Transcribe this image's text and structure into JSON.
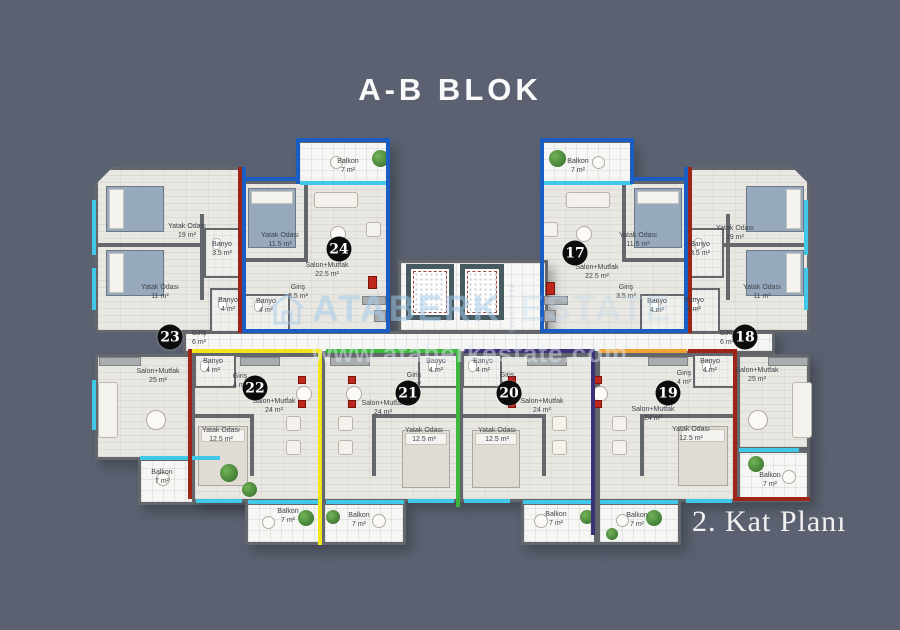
{
  "title": "A-B BLOK",
  "floor_label": "2. Kat Planı",
  "watermark": {
    "brand": "ATABERK",
    "brand_secondary": "ESTATE",
    "tagline": "REAL ESTATE",
    "url": "www.ataberkestate.com"
  },
  "colors": {
    "background": "#5b6170",
    "floor": "#e9e7e2",
    "tile": "#f6f6f4",
    "wall": "#64676b",
    "window_glass": "#41c7e8",
    "badge": "#0c0c0c",
    "outline_red": "#9c2518",
    "outline_blue": "#1a5ec4",
    "outline_yellow": "#f2e41c",
    "outline_green": "#3cb93c",
    "outline_navy": "#3a3176",
    "outline_orange": "#f2a336"
  },
  "apartments": [
    {
      "number": "23",
      "outline_color": "#9c2518",
      "badge": {
        "x": 170,
        "y": 337
      },
      "outline": [
        [
          238,
          167,
          4,
          166
        ],
        [
          188,
          349,
          56,
          4
        ],
        [
          188,
          349,
          4,
          150
        ]
      ],
      "rooms": [
        {
          "name": "Yatak Odası",
          "area": "19 m²",
          "x": 187,
          "y": 231
        },
        {
          "name": "Banyo",
          "area": "3.5 m²",
          "x": 222,
          "y": 249
        },
        {
          "name": "Yatak Odası",
          "area": "11 m²",
          "x": 160,
          "y": 292
        },
        {
          "name": "Banyo",
          "area": "4 m²",
          "x": 228,
          "y": 305
        },
        {
          "name": "Giriş",
          "area": "6 m²",
          "x": 199,
          "y": 338
        },
        {
          "name": "Salon+Mutfak",
          "area": "25 m²",
          "x": 158,
          "y": 376
        },
        {
          "name": "Balkon",
          "area": "7 m²",
          "x": 162,
          "y": 477
        }
      ]
    },
    {
      "number": "24",
      "outline_color": "#1a5ec4",
      "badge": {
        "x": 339,
        "y": 249
      },
      "outline": [
        [
          242,
          167,
          4,
          166
        ],
        [
          242,
          177,
          58,
          4
        ],
        [
          296,
          138,
          4,
          46
        ],
        [
          296,
          138,
          94,
          4
        ],
        [
          386,
          138,
          4,
          195
        ],
        [
          242,
          329,
          148,
          4
        ]
      ],
      "rooms": [
        {
          "name": "Balkon",
          "area": "7 m²",
          "x": 348,
          "y": 166
        },
        {
          "name": "Yatak Odası",
          "area": "11.5 m²",
          "x": 280,
          "y": 240
        },
        {
          "name": "Salon+Mutfak",
          "area": "22.5 m²",
          "x": 327,
          "y": 270
        },
        {
          "name": "Giriş",
          "area": "3.5 m²",
          "x": 298,
          "y": 292
        },
        {
          "name": "Banyo",
          "area": "4 m²",
          "x": 266,
          "y": 306
        }
      ]
    },
    {
      "number": "17",
      "outline_color": "#1a5ec4",
      "badge": {
        "x": 575,
        "y": 253
      },
      "outline": [
        [
          684,
          167,
          4,
          166
        ],
        [
          630,
          177,
          58,
          4
        ],
        [
          630,
          138,
          4,
          46
        ],
        [
          540,
          138,
          94,
          4
        ],
        [
          540,
          138,
          4,
          195
        ],
        [
          540,
          329,
          148,
          4
        ]
      ],
      "rooms": [
        {
          "name": "Balkon",
          "area": "7 m²",
          "x": 578,
          "y": 166
        },
        {
          "name": "Yatak Odası",
          "area": "11.5 m²",
          "x": 638,
          "y": 240
        },
        {
          "name": "Salon+Mutfak",
          "area": "22.5 m²",
          "x": 597,
          "y": 272
        },
        {
          "name": "Giriş",
          "area": "3.5 m²",
          "x": 626,
          "y": 292
        },
        {
          "name": "Banyo",
          "area": "4 m²",
          "x": 657,
          "y": 306
        }
      ]
    },
    {
      "number": "18",
      "outline_color": "#9c2518",
      "badge": {
        "x": 745,
        "y": 337
      },
      "outline": [
        [
          688,
          167,
          4,
          166
        ],
        [
          688,
          349,
          49,
          4
        ],
        [
          733,
          349,
          4,
          152
        ],
        [
          733,
          497,
          77,
          4
        ]
      ],
      "rooms": [
        {
          "name": "Yatak Odası",
          "area": "19 m²",
          "x": 735,
          "y": 233
        },
        {
          "name": "Banyo",
          "area": "3.5 m²",
          "x": 700,
          "y": 249
        },
        {
          "name": "Yatak Odası",
          "area": "11 m²",
          "x": 762,
          "y": 292
        },
        {
          "name": "Banyo",
          "area": "4 m²",
          "x": 694,
          "y": 305
        },
        {
          "name": "Giriş",
          "area": "6 m²",
          "x": 727,
          "y": 338
        },
        {
          "name": "Salon+Mutfak",
          "area": "25 m²",
          "x": 757,
          "y": 375
        },
        {
          "name": "Balkon",
          "area": "7 m²",
          "x": 770,
          "y": 480
        }
      ]
    },
    {
      "number": "22",
      "outline_color": "#f2e41c",
      "badge": {
        "x": 255,
        "y": 388
      },
      "outline": [
        [
          192,
          349,
          130,
          4
        ],
        [
          318,
          349,
          4,
          196
        ]
      ],
      "rooms": [
        {
          "name": "Banyo",
          "area": "4 m²",
          "x": 213,
          "y": 366
        },
        {
          "name": "Giriş",
          "area": "4 m²",
          "x": 240,
          "y": 381
        },
        {
          "name": "Salon+Mutfak",
          "area": "24 m²",
          "x": 274,
          "y": 406
        },
        {
          "name": "Yatak Odası",
          "area": "12.5 m²",
          "x": 221,
          "y": 435
        },
        {
          "name": "Balkon",
          "area": "7 m²",
          "x": 288,
          "y": 516
        }
      ]
    },
    {
      "number": "21",
      "outline_color": "#3cb93c",
      "badge": {
        "x": 408,
        "y": 393
      },
      "outline": [
        [
          326,
          349,
          134,
          4
        ],
        [
          456,
          349,
          4,
          158
        ]
      ],
      "rooms": [
        {
          "name": "Banyo",
          "area": "4 m²",
          "x": 436,
          "y": 366
        },
        {
          "name": "Giriş",
          "area": "4 m²",
          "x": 414,
          "y": 380
        },
        {
          "name": "Salon+Mutfak",
          "area": "24 m²",
          "x": 383,
          "y": 408
        },
        {
          "name": "Yatak Odası",
          "area": "12.5 m²",
          "x": 424,
          "y": 435
        },
        {
          "name": "Balkon",
          "area": "7 m²",
          "x": 359,
          "y": 520
        }
      ]
    },
    {
      "number": "20",
      "outline_color": "#3a3176",
      "badge": {
        "x": 509,
        "y": 393
      },
      "outline": [
        [
          464,
          349,
          131,
          4
        ],
        [
          591,
          349,
          4,
          186
        ]
      ],
      "rooms": [
        {
          "name": "Banyo",
          "area": "4 m²",
          "x": 483,
          "y": 366
        },
        {
          "name": "Giriş",
          "area": "4 m²",
          "x": 507,
          "y": 380
        },
        {
          "name": "Salon+Mutfak",
          "area": "24 m²",
          "x": 542,
          "y": 406
        },
        {
          "name": "Yatak Odası",
          "area": "12.5 m²",
          "x": 497,
          "y": 435
        },
        {
          "name": "Balkon",
          "area": "7 m²",
          "x": 556,
          "y": 519
        }
      ]
    },
    {
      "number": "19",
      "outline_color": "#f2a336",
      "badge": {
        "x": 668,
        "y": 393
      },
      "outline": [
        [
          599,
          349,
          88,
          4
        ]
      ],
      "rooms": [
        {
          "name": "Banyo",
          "area": "4 m²",
          "x": 710,
          "y": 366
        },
        {
          "name": "Giriş",
          "area": "4 m²",
          "x": 684,
          "y": 378
        },
        {
          "name": "Salon+Mutfak",
          "area": "24 m²",
          "x": 653,
          "y": 414
        },
        {
          "name": "Yatak Odası",
          "area": "12.5 m²",
          "x": 691,
          "y": 434
        },
        {
          "name": "Balkon",
          "area": "7 m²",
          "x": 637,
          "y": 520
        }
      ]
    },
    {
      "_": null
    }
  ],
  "furniture": [
    {
      "type": "bed-blue",
      "x": 106,
      "y": 186,
      "w": 58,
      "h": 46,
      "dir": "left"
    },
    {
      "type": "bed-blue",
      "x": 106,
      "y": 250,
      "w": 58,
      "h": 46,
      "dir": "left"
    },
    {
      "type": "bed-blue",
      "x": 746,
      "y": 186,
      "w": 58,
      "h": 46,
      "dir": "right"
    },
    {
      "type": "bed-blue",
      "x": 746,
      "y": 250,
      "w": 58,
      "h": 46,
      "dir": "right"
    },
    {
      "type": "bed-blue",
      "x": 248,
      "y": 188,
      "w": 48,
      "h": 60,
      "dir": "top"
    },
    {
      "type": "bed-blue",
      "x": 634,
      "y": 188,
      "w": 48,
      "h": 60,
      "dir": "top"
    },
    {
      "type": "bed-light",
      "x": 198,
      "y": 426,
      "w": 50,
      "h": 60,
      "dir": "top"
    },
    {
      "type": "bed-light",
      "x": 402,
      "y": 430,
      "w": 48,
      "h": 58,
      "dir": "top"
    },
    {
      "type": "bed-light",
      "x": 472,
      "y": 430,
      "w": 48,
      "h": 58,
      "dir": "top"
    },
    {
      "type": "bed-light",
      "x": 678,
      "y": 426,
      "w": 50,
      "h": 60,
      "dir": "top"
    },
    {
      "type": "sofa",
      "x": 98,
      "y": 382,
      "w": 20,
      "h": 56
    },
    {
      "type": "sofa",
      "x": 792,
      "y": 382,
      "w": 20,
      "h": 56
    },
    {
      "type": "sofa",
      "x": 314,
      "y": 192,
      "w": 44,
      "h": 16
    },
    {
      "type": "sofa",
      "x": 566,
      "y": 192,
      "w": 44,
      "h": 16
    },
    {
      "type": "armchair",
      "x": 366,
      "y": 222,
      "w": 15,
      "h": 15
    },
    {
      "type": "armchair",
      "x": 543,
      "y": 222,
      "w": 15,
      "h": 15
    },
    {
      "type": "armchair",
      "x": 286,
      "y": 416,
      "w": 15,
      "h": 15
    },
    {
      "type": "armchair",
      "x": 286,
      "y": 440,
      "w": 15,
      "h": 15
    },
    {
      "type": "armchair",
      "x": 338,
      "y": 416,
      "w": 15,
      "h": 15
    },
    {
      "type": "armchair",
      "x": 338,
      "y": 440,
      "w": 15,
      "h": 15
    },
    {
      "type": "armchair",
      "x": 552,
      "y": 416,
      "w": 15,
      "h": 15
    },
    {
      "type": "armchair",
      "x": 552,
      "y": 440,
      "w": 15,
      "h": 15
    },
    {
      "type": "armchair",
      "x": 612,
      "y": 416,
      "w": 15,
      "h": 15
    },
    {
      "type": "armchair",
      "x": 612,
      "y": 440,
      "w": 15,
      "h": 15
    },
    {
      "type": "table-round",
      "x": 146,
      "y": 410,
      "w": 20,
      "h": 20
    },
    {
      "type": "table-round",
      "x": 748,
      "y": 410,
      "w": 20,
      "h": 20
    },
    {
      "type": "table-round",
      "x": 330,
      "y": 226,
      "w": 16,
      "h": 16
    },
    {
      "type": "table-round",
      "x": 576,
      "y": 226,
      "w": 16,
      "h": 16
    },
    {
      "type": "table-round",
      "x": 296,
      "y": 386,
      "w": 16,
      "h": 16
    },
    {
      "type": "table-round",
      "x": 346,
      "y": 386,
      "w": 16,
      "h": 16
    },
    {
      "type": "table-round",
      "x": 506,
      "y": 386,
      "w": 16,
      "h": 16
    },
    {
      "type": "table-round",
      "x": 592,
      "y": 386,
      "w": 16,
      "h": 16
    },
    {
      "type": "table-round",
      "x": 330,
      "y": 156,
      "w": 13,
      "h": 13
    },
    {
      "type": "table-round",
      "x": 592,
      "y": 156,
      "w": 13,
      "h": 13
    },
    {
      "type": "table-round",
      "x": 156,
      "y": 472,
      "w": 14,
      "h": 14
    },
    {
      "type": "table-round",
      "x": 782,
      "y": 470,
      "w": 14,
      "h": 14
    },
    {
      "type": "table-round",
      "x": 262,
      "y": 516,
      "w": 13,
      "h": 13
    },
    {
      "type": "table-round",
      "x": 372,
      "y": 514,
      "w": 14,
      "h": 14
    },
    {
      "type": "table-round",
      "x": 534,
      "y": 514,
      "w": 14,
      "h": 14
    },
    {
      "type": "table-round",
      "x": 616,
      "y": 514,
      "w": 13,
      "h": 13
    },
    {
      "type": "chair-red",
      "x": 298,
      "y": 376,
      "w": 8,
      "h": 8
    },
    {
      "type": "chair-red",
      "x": 298,
      "y": 400,
      "w": 8,
      "h": 8
    },
    {
      "type": "chair-red",
      "x": 348,
      "y": 376,
      "w": 8,
      "h": 8
    },
    {
      "type": "chair-red",
      "x": 348,
      "y": 400,
      "w": 8,
      "h": 8
    },
    {
      "type": "chair-red",
      "x": 508,
      "y": 376,
      "w": 8,
      "h": 8
    },
    {
      "type": "chair-red",
      "x": 508,
      "y": 400,
      "w": 8,
      "h": 8
    },
    {
      "type": "chair-red",
      "x": 594,
      "y": 376,
      "w": 8,
      "h": 8
    },
    {
      "type": "chair-red",
      "x": 594,
      "y": 400,
      "w": 8,
      "h": 8
    },
    {
      "type": "counter",
      "x": 99,
      "y": 357,
      "w": 42,
      "h": 9
    },
    {
      "type": "counter",
      "x": 240,
      "y": 357,
      "w": 40,
      "h": 9
    },
    {
      "type": "counter",
      "x": 330,
      "y": 357,
      "w": 40,
      "h": 9
    },
    {
      "type": "counter",
      "x": 527,
      "y": 357,
      "w": 40,
      "h": 9
    },
    {
      "type": "counter",
      "x": 648,
      "y": 357,
      "w": 40,
      "h": 9
    },
    {
      "type": "counter",
      "x": 768,
      "y": 357,
      "w": 40,
      "h": 9
    },
    {
      "type": "counter",
      "x": 362,
      "y": 296,
      "w": 24,
      "h": 9
    },
    {
      "type": "counter",
      "x": 374,
      "y": 310,
      "w": 12,
      "h": 12
    },
    {
      "type": "counter",
      "x": 544,
      "y": 296,
      "w": 24,
      "h": 9
    },
    {
      "type": "counter",
      "x": 544,
      "y": 310,
      "w": 12,
      "h": 12
    },
    {
      "type": "cabinet-red",
      "x": 368,
      "y": 276,
      "w": 9,
      "h": 13
    },
    {
      "type": "cabinet-red",
      "x": 546,
      "y": 282,
      "w": 9,
      "h": 13
    },
    {
      "type": "plant",
      "x": 372,
      "y": 150,
      "w": 17,
      "h": 17
    },
    {
      "type": "plant",
      "x": 549,
      "y": 150,
      "w": 17,
      "h": 17
    },
    {
      "type": "plant",
      "x": 220,
      "y": 464,
      "w": 18,
      "h": 18
    },
    {
      "type": "plant",
      "x": 242,
      "y": 482,
      "w": 15,
      "h": 15
    },
    {
      "type": "plant",
      "x": 748,
      "y": 456,
      "w": 16,
      "h": 16
    },
    {
      "type": "plant",
      "x": 298,
      "y": 510,
      "w": 16,
      "h": 16
    },
    {
      "type": "plant",
      "x": 326,
      "y": 510,
      "w": 14,
      "h": 14
    },
    {
      "type": "plant",
      "x": 580,
      "y": 510,
      "w": 14,
      "h": 14
    },
    {
      "type": "plant",
      "x": 646,
      "y": 510,
      "w": 16,
      "h": 16
    },
    {
      "type": "plant",
      "x": 606,
      "y": 528,
      "w": 12,
      "h": 12
    },
    {
      "type": "wc",
      "x": 212,
      "y": 238,
      "w": 9,
      "h": 12
    },
    {
      "type": "wc",
      "x": 218,
      "y": 298,
      "w": 9,
      "h": 12
    },
    {
      "type": "wc",
      "x": 254,
      "y": 300,
      "w": 9,
      "h": 12
    },
    {
      "type": "wc",
      "x": 650,
      "y": 300,
      "w": 9,
      "h": 12
    },
    {
      "type": "wc",
      "x": 694,
      "y": 238,
      "w": 9,
      "h": 12
    },
    {
      "type": "wc",
      "x": 690,
      "y": 298,
      "w": 9,
      "h": 12
    },
    {
      "type": "wc",
      "x": 200,
      "y": 360,
      "w": 9,
      "h": 12
    },
    {
      "type": "wc",
      "x": 428,
      "y": 360,
      "w": 9,
      "h": 12
    },
    {
      "type": "wc",
      "x": 468,
      "y": 360,
      "w": 9,
      "h": 12
    },
    {
      "type": "wc",
      "x": 702,
      "y": 360,
      "w": 9,
      "h": 12
    }
  ]
}
